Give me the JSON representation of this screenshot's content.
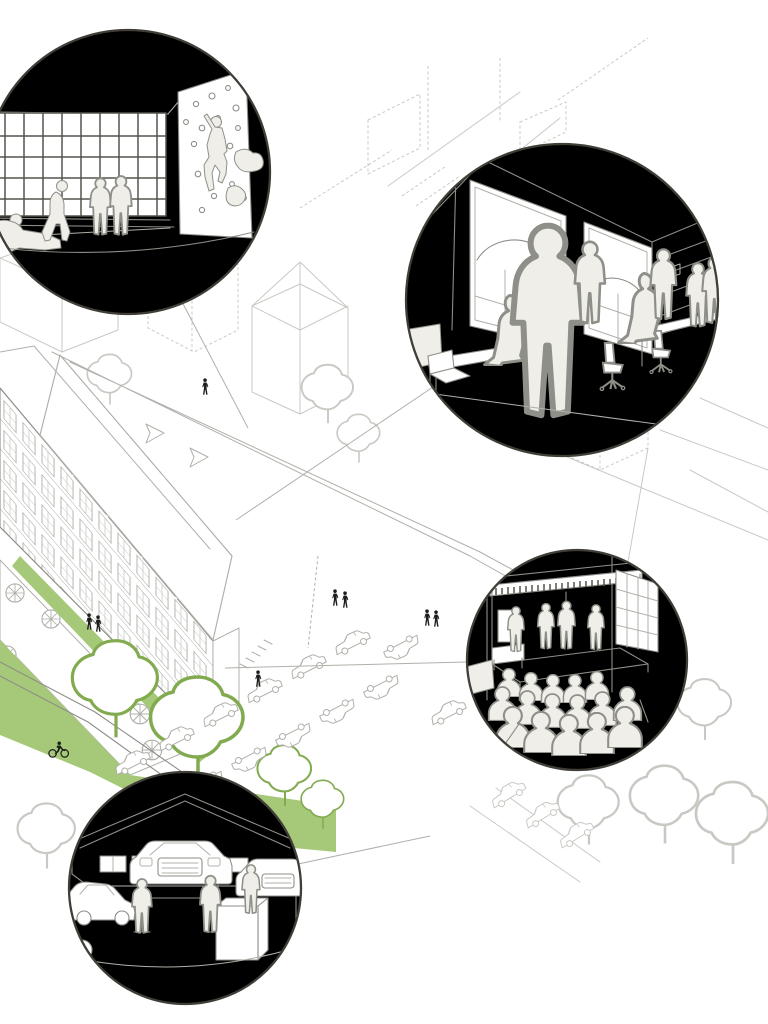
{
  "document": {
    "title": "Urban block axonometric illustration with four programme vignettes",
    "type": "architectural-illustration"
  },
  "canvas": {
    "width": 768,
    "height": 1024
  },
  "colors": {
    "paper": "#ffffff",
    "ink_faint": "#c9c9c4",
    "ink_light": "#b0b0aa",
    "ink_mid": "#8e8e88",
    "ink_dark": "#55534c",
    "circle_stroke": "#403e37",
    "green": "#a6c979",
    "green_line": "#82ab50",
    "figure_fill": "#efeee8",
    "figure_line": "#8f8f89",
    "black": "#1d1d1b"
  },
  "callouts": [
    {
      "id": "climbing-hall",
      "scene": "bouldering-gym vignette",
      "people": 7,
      "features": [
        "industrial window grid",
        "climbing wall with holds",
        "climber",
        "spectators"
      ]
    },
    {
      "id": "coworking-office",
      "scene": "co-working office vignette",
      "people": 7,
      "features": [
        "arched windows",
        "shared desks",
        "swivel chairs",
        "laptop",
        "shelving"
      ]
    },
    {
      "id": "event-stage",
      "scene": "event space vignette",
      "people": 16,
      "features": [
        "stage",
        "fringed canopy",
        "audience rows",
        "grid window"
      ]
    },
    {
      "id": "car-workshop",
      "scene": "auto repair workshop vignette",
      "people": 3,
      "cars": 3,
      "features": [
        "gabled hall",
        "cars on lifts",
        "tool cabinet",
        "spare tyres"
      ]
    }
  ],
  "map": {
    "main_building": "factory block with gridded window facade and sawtooth skylights",
    "green_corridor": {
      "trees": 4,
      "cyclists": 1
    },
    "cafe_terrace": {
      "parasols": 5,
      "people": 2
    },
    "parking": {
      "cars": 16
    },
    "pedestrians": 6,
    "surroundings": "dashed massing of neighbouring blocks and stepped terraces"
  }
}
